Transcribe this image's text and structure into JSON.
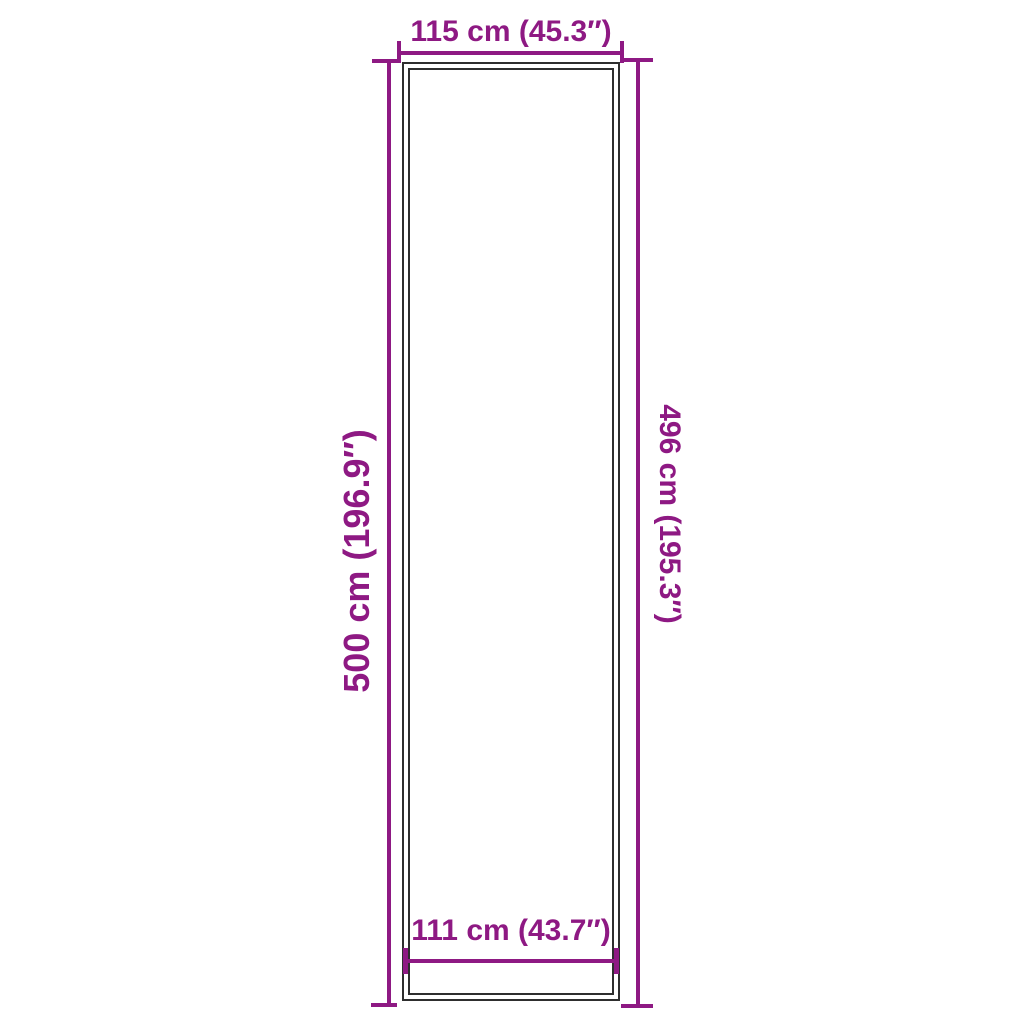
{
  "colors": {
    "accent": "#8E1983",
    "outline": "#2E2E2E",
    "background": "#FFFFFF"
  },
  "diagram": {
    "type": "product-dimension-diagram",
    "shape": "tall-rectangle-with-inner-frame"
  },
  "dimensions": {
    "top": {
      "label": "115 cm (45.3″)",
      "cm": 115,
      "inches": 45.3,
      "measures": "outer width"
    },
    "bottom": {
      "label": "111 cm (43.7″)",
      "cm": 111,
      "inches": 43.7,
      "measures": "inner width"
    },
    "left": {
      "label": "500 cm (196.9″)",
      "cm": 500,
      "inches": 196.9,
      "measures": "outer height"
    },
    "right": {
      "label": "496 cm (195.3″)",
      "cm": 496,
      "inches": 195.3,
      "measures": "inner height"
    }
  }
}
